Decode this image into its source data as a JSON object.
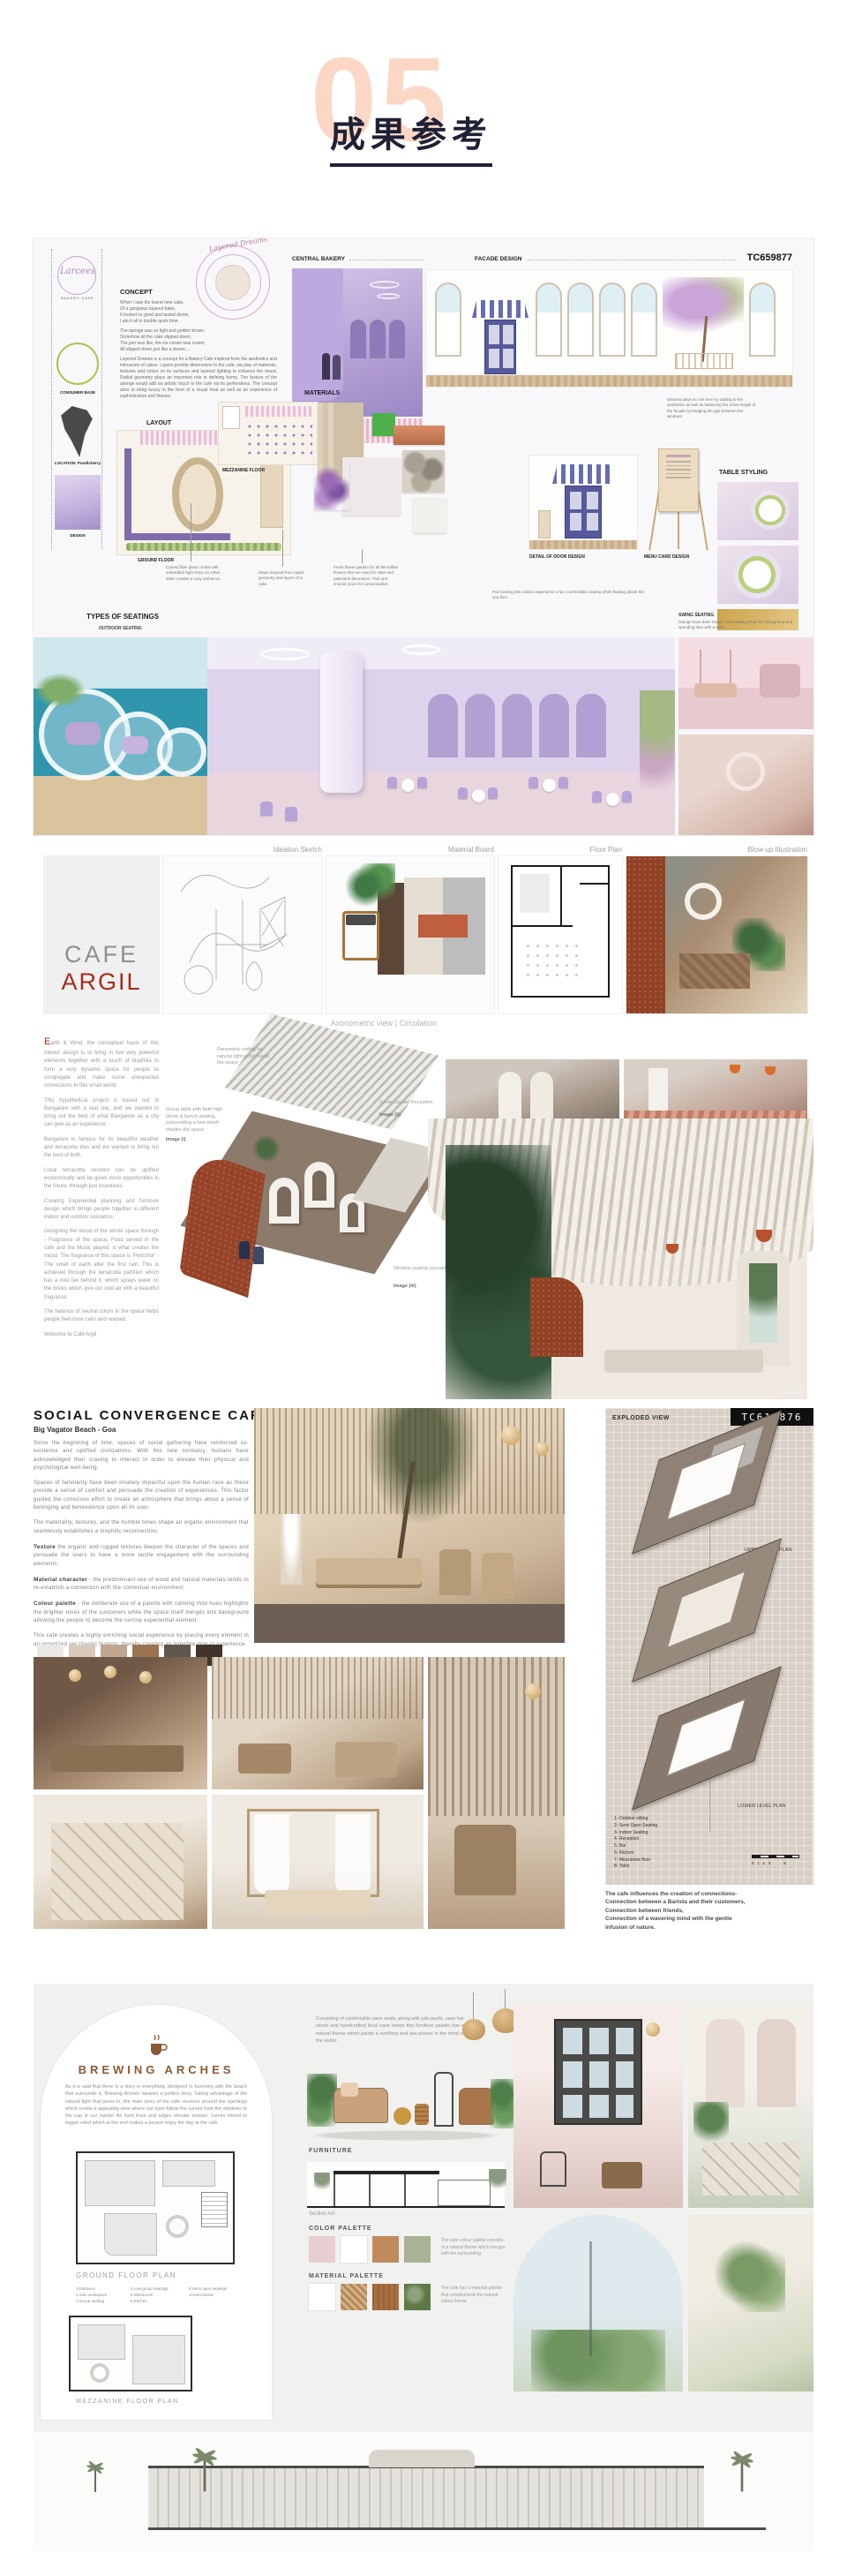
{
  "header": {
    "number": "05",
    "title": "成果参考"
  },
  "board1": {
    "code": "TC659877",
    "logo_name": "Larcees",
    "logo_sub": "BAKERY CAFE",
    "diagram_title": "Layered Dreams",
    "labels": {
      "concept": "CONCEPT",
      "consumer_base": "CONSUMER BASE",
      "location": "LOCATION: Pondicherry",
      "design": "DESIGN",
      "layout": "LAYOUT",
      "ground_floor": "GROUND FLOOR",
      "mezzanine_floor": "MEZZANINE FLOOR",
      "materials": "MATERIALS",
      "central_bakery": "CENTRAL BAKERY",
      "facade_design": "FACADE DESIGN",
      "table_styling": "TABLE STYLING",
      "types_of_seatings": "TYPES OF SEATINGS",
      "outdoor_seating": "OUTDOOR SEATING",
      "swing_seating": "SWING SEATING",
      "door_detail": "DETAIL OF DOOR DESIGN",
      "menu_card": "MENU CARD DESIGN"
    },
    "poem1": "When I saw the brand new cake,\nOf a gorgeous layered bake,\nIt looked so good and tasted divine,\nI ate it all in double quick time.",
    "poem2": "The sponge was so light and golden brown,\nSomehow all the cake slipped down,\nThe jam was like, the ice cream was cream,\nAll slipped down just like a dream ...",
    "concept_text": "Layered Dreams is a concept for a Bakery Cafe inspired from the aesthetics and intricacies of cakes. Layers provide dimensions to the cafe, via play of materials, textures and colors on its surfaces and layered lighting to enhance the mood. Radial geometry plays an important role in defining forms. The texture of the sponge would add an artistic touch to the cafe via its perforations. The concept aims to bring luxury in the form of a visual treat as well as an experience of sophistication and finesse.",
    "ann_wisteria": "Wisteria plays its role here by adding to the aesthetics as well as balancing the entire length of the facade by bridging the gap between the windows",
    "ann_fiber": "Carved fiber glass circles with embedded light strips on either sides creates a cozy ambience",
    "ann_steps": "Steps inspired from radial geometry and layers of a cake",
    "ann_flowers": "Fresh flower garden for all the edible flowers that are used for cake and patisserie decoration. Pick and choose yours for customisation",
    "ann_swing": "Swings have been hung in two seating areas for having food and spending time with a view",
    "ann_outdoor": "Pod seating lets visitors experience a fun, comfortable seating while floating above the sea floor"
  },
  "board2": {
    "panel_labels": [
      "Ideation Sketch",
      "Material Board",
      "Floor Plan",
      "Blow-up Illustration"
    ],
    "axo_label": "Axonometric view  |  Circulation",
    "title1": "CAFE",
    "title2": "ARGIL",
    "paragraphs": [
      "Earth & Wind, the conceptual basis of this interior design is to bring in two very powerful elements together with a touch of biophilia to form a very dynamic space for people to congregate and make some unexpected connections in this small world.",
      "This hypothetical project is based out in Bangalore with a real site, and we wanted to bring out the best of what Bangalore as a city can give as an experience.",
      "Bangalore is famous for its beautiful weather and terracotta tiles and we wanted to bring out the best of both.",
      "Local terracotta vendors can be uplifted economically and be given more opportunities in the future, through just incentives.",
      "Creating Experiential planning and furniture design which brings people together in different indoor and outdoor scenarios.",
      "Designing the mood of the whole space through - Fragrance of the space, Food served in the cafe and the Music played, is what creates the mood. The fragrance of this space is 'Petrichor' - The smell of earth after the first rain. This is achieved through the terracotta partition which has a mist fan behind it, which sprays water on the bricks which give out cold air with a beautiful fragrance.",
      "The balance of neutral colors in the space helps people feel more calm and relaxed."
    ],
    "welcome": "Welcome to Cafe Argil",
    "ann_parametric": "Parametric ceiling for natural light to fall inside the space",
    "ann_group": "Group table with both high stools & bench seating, surrounding a tree which shades the space",
    "ann_serve": "Serve counter Reception",
    "ann_window": "Window seating concept",
    "img1": "Image (i)",
    "img2": "Image (ii)",
    "img3": "Image (iii)"
  },
  "board3": {
    "title": "SOCIAL CONVERGENCE CAFE",
    "subtitle": "Big Vagator Beach - Goa",
    "p1": "Since the beginning of time, spaces of social gathering have reinforced co-existence and uplifted civilizations. With this new normalcy, humans have acknowledged their craving to interact in order to elevate their physical and psychological well-being.",
    "p2": "Spaces of familiarity have been innately impactful upon the human race as these provide a sense of comfort and persuade the creation of experiences. This factor guided the conscious effort to create an atmosphere that brings about a sense of belonging and benevolence upon all its user.",
    "p3": "The materiality, textures, and the humble tones shape an organic environment that seamlessly establishes a biophilic reconnection.",
    "texture_label": "Texture",
    "texture_text": " the organic and rugged textures deepen the character of the spaces and persuade the users to have a more tactile engagement with the surrounding elements.",
    "material_label": "Material character",
    "material_text": " - the predominant use of wood and natural materials tends to re-establish a connection with the contextual environment.",
    "colour_label": "Colour palette",
    "colour_text": " - the deliberate use of a palette with calming mild hues highlights the brighter tones of the customers while the space itself merges into background allowing the people to become the central experiential element.",
    "p_last": "This cafe creates a highly enriching social experience by placing every element in an organized yet chaotic fashion, thereby creating an indelible dine-in experience.",
    "palette": [
      "#ebe9e6",
      "#d9cabb",
      "#c0a68e",
      "#9b7351",
      "#605650",
      "#43332a"
    ],
    "exploded_label": "EXPLODED VIEW",
    "code": "TC619876",
    "upper_label": "UPPER LEVEL PLAN",
    "lower_label": "LOWER LEVEL PLAN",
    "legend": [
      "1- Outdoor sitting",
      "2- Semi Open Seating",
      "3- Indoor Seating",
      "4- Reception",
      "5- Bar",
      "6- Kitchen",
      "7- Mezzanine floor",
      "8- Toilet"
    ],
    "scale_text": "0   1   2   3            5",
    "connections": "The cafe influences the creation of connections-\nConnection between a Barista and their customers,\nConnection between friends,\nConnection of a wavering mind with the gentle\ninfusion of nature."
  },
  "board4": {
    "title": "BREWING ARCHES",
    "intro": "As it is said that there is a story in everything, designed in harmony with the beach that surrounds it, 'Brewing Arches' weaves a perfect story. Taking advantage of the natural light that pours in, the main story of the cafe revolves around the openings which create a appealing view where our eyes follow the curves from the windows to the cup in our hands! As hard lines and edges elevate tension, curves intend to trigger relief which at the end makes a person enjoy the day at the cafe.",
    "ground_label": "GROUND FLOOR PLAN",
    "mezz_label": "MEZZANINE FLOOR PLAN",
    "legend_col1": [
      "1.Entrance",
      "2.Solo workspace",
      "3.Group seating"
    ],
    "legend_col2": [
      "4.Low group seatings",
      "5.Washroom",
      "6.Kitchen"
    ],
    "legend_col3": [
      "9.Semi open seatings",
      "10.Mezzanine"
    ],
    "furniture_text": "Consisting of comfortable cane seats, along with jute poufs, cane bar stools and handcrafted local cane lamps this furniture palette has a natural theme which paints a soothing and raw picture in the mind of the visitor.",
    "furniture_label": "FURNITURE",
    "section_label": "Section AA'",
    "color_label": "COLOR PALETTE",
    "color_text": "The cafe colour palette consists of a natural theme which merges with the surrounding",
    "color_swatches": [
      "#e7ced3",
      "#ffffff",
      "#c08a5c",
      "#a9b293"
    ],
    "material_label": "MATERIAL PALETTE",
    "material_text": "The cafe has a material palette that complements the natural colour theme",
    "material_swatches": [
      "#ffffff",
      "#b5874e",
      "#a86f3f",
      "#5d7a46"
    ]
  }
}
